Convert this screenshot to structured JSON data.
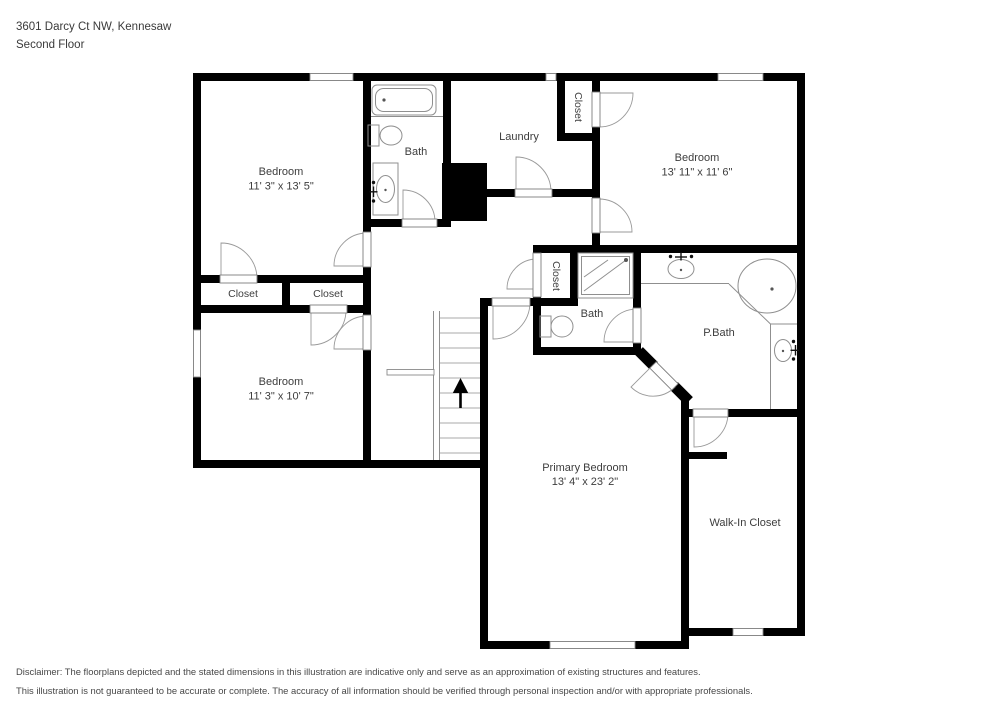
{
  "colors": {
    "wall": "#000000",
    "fixture_line": "#8f8f8f",
    "label_text": "#3d3d3d"
  },
  "header": {
    "address": "3601 Darcy Ct NW, Kennesaw",
    "floor": "Second Floor"
  },
  "rooms": {
    "bedroom_top_left": {
      "label": "Bedroom",
      "dims": "11' 3\" x 13' 5\""
    },
    "bath_top": {
      "label": "Bath"
    },
    "laundry": {
      "label": "Laundry"
    },
    "closet_bedroom_right": {
      "label": "Closet"
    },
    "bedroom_right": {
      "label": "Bedroom",
      "dims": "13' 11\" x 11' 6\""
    },
    "closet_left_a": {
      "label": "Closet"
    },
    "closet_left_b": {
      "label": "Closet"
    },
    "bedroom_bottom_left": {
      "label": "Bedroom",
      "dims": "11' 3\" x 10' 7\""
    },
    "closet_hall": {
      "label": "Closet"
    },
    "bath_hall": {
      "label": "Bath"
    },
    "primary_bath": {
      "label": "P.Bath"
    },
    "primary_bedroom": {
      "label": "Primary Bedroom",
      "dims": "13' 4\" x 23' 2\""
    },
    "walk_in_closet": {
      "label": "Walk-In Closet"
    }
  },
  "footer": {
    "disclaimer_line1": "Disclaimer: The floorplans depicted and the stated dimensions in this illustration are indicative only and serve as an approximation of existing structures and features.",
    "disclaimer_line2": "This illustration is not guaranteed to be accurate or complete. The accuracy of all information should be verified through personal inspection and/or with appropriate professionals."
  }
}
